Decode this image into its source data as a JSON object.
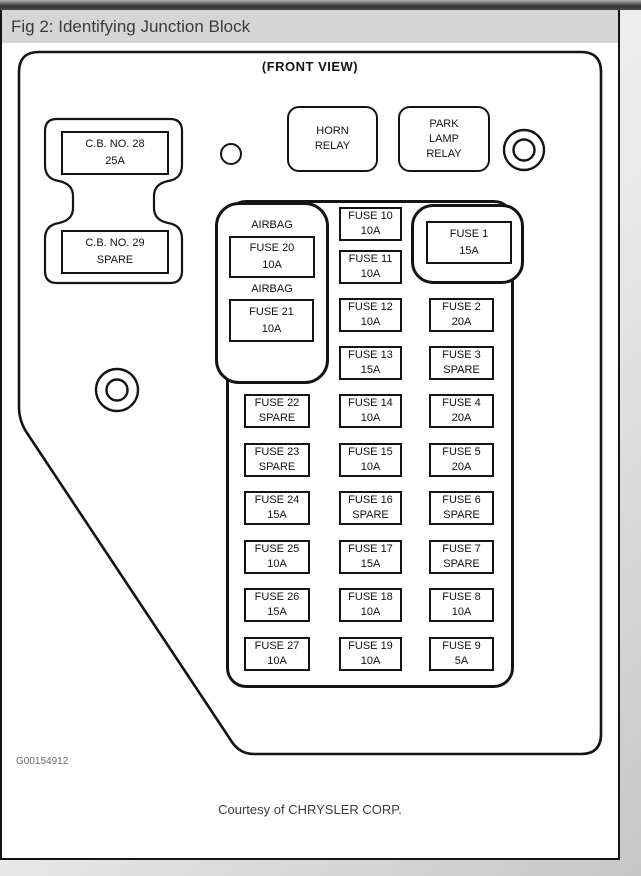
{
  "window": {
    "title": "Fig 2: Identifying Junction Block"
  },
  "diagram": {
    "view_label": "(FRONT VIEW)",
    "graphic_id": "G00154912",
    "courtesy_note": "Courtesy of CHRYSLER CORP.",
    "circuit_breakers": [
      {
        "name": "C.B. NO. 28",
        "rating": "25A"
      },
      {
        "name": "C.B. NO. 29",
        "rating": "SPARE"
      }
    ],
    "relays": {
      "horn": {
        "lines": [
          "HORN",
          "RELAY"
        ]
      },
      "park": {
        "lines": [
          "PARK",
          "LAMP",
          "RELAY"
        ]
      }
    },
    "airbag_block": {
      "label": "AIRBAG",
      "fuses": [
        {
          "name": "FUSE 20",
          "rating": "10A"
        },
        {
          "name": "FUSE 21",
          "rating": "10A"
        }
      ]
    },
    "fuse1_block": {
      "name": "FUSE 1",
      "rating": "15A"
    },
    "fuse_columns": {
      "left": [
        {
          "name": "FUSE 22",
          "rating": "SPARE"
        },
        {
          "name": "FUSE 23",
          "rating": "SPARE"
        },
        {
          "name": "FUSE 24",
          "rating": "15A"
        },
        {
          "name": "FUSE 25",
          "rating": "10A"
        },
        {
          "name": "FUSE 26",
          "rating": "15A"
        },
        {
          "name": "FUSE 27",
          "rating": "10A"
        }
      ],
      "mid": [
        {
          "name": "FUSE 10",
          "rating": "10A"
        },
        {
          "name": "FUSE 11",
          "rating": "10A"
        },
        {
          "name": "FUSE 12",
          "rating": "10A"
        },
        {
          "name": "FUSE 13",
          "rating": "15A"
        },
        {
          "name": "FUSE 14",
          "rating": "10A"
        },
        {
          "name": "FUSE 15",
          "rating": "10A"
        },
        {
          "name": "FUSE 16",
          "rating": "SPARE"
        },
        {
          "name": "FUSE 17",
          "rating": "15A"
        },
        {
          "name": "FUSE 18",
          "rating": "10A"
        },
        {
          "name": "FUSE 19",
          "rating": "10A"
        }
      ],
      "right": [
        {
          "name": "FUSE 2",
          "rating": "20A"
        },
        {
          "name": "FUSE 3",
          "rating": "SPARE"
        },
        {
          "name": "FUSE 4",
          "rating": "20A"
        },
        {
          "name": "FUSE 5",
          "rating": "20A"
        },
        {
          "name": "FUSE 6",
          "rating": "SPARE"
        },
        {
          "name": "FUSE 7",
          "rating": "SPARE"
        },
        {
          "name": "FUSE 8",
          "rating": "10A"
        },
        {
          "name": "FUSE 9",
          "rating": "5A"
        }
      ]
    },
    "colors": {
      "ink": "#141414",
      "title_bar_bg": "#d5d5d5",
      "title_text": "#3a3a3a"
    }
  }
}
